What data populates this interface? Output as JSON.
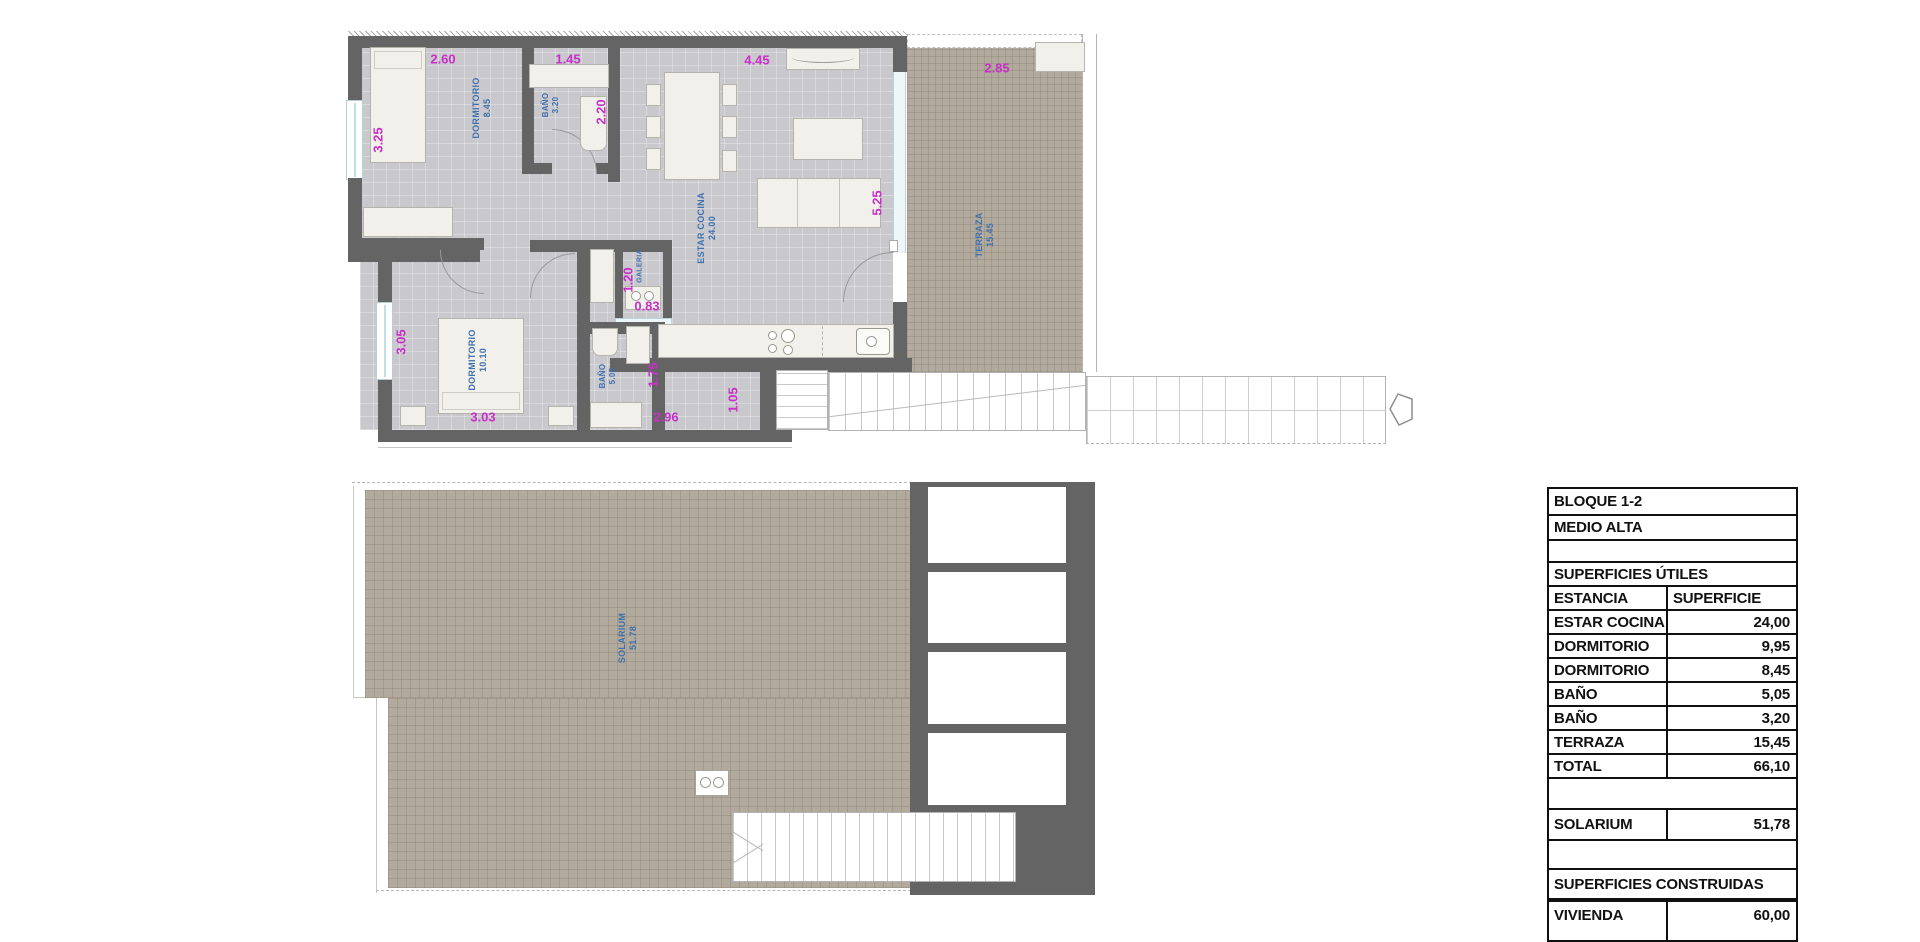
{
  "plan_upper": {
    "rooms": {
      "dormitorio1": {
        "name": "DORMITORIO",
        "area": "8.45"
      },
      "bano1": {
        "name": "BAÑO",
        "area": "3.20"
      },
      "estar_cocina": {
        "name": "ESTAR COCINA",
        "area": "24.00"
      },
      "galeria": {
        "name": "GALERIA"
      },
      "dormitorio2": {
        "name": "DORMITORIO",
        "area": "10.10"
      },
      "bano2": {
        "name": "BAÑO",
        "area": "5.05"
      },
      "terraza": {
        "name": "TERRAZA",
        "area": "15.45"
      }
    },
    "dimensions": {
      "dorm1_width": "2.60",
      "bano1_width": "1.45",
      "estar_width": "4.45",
      "terraza_width": "2.85",
      "dorm1_depth": "3.25",
      "bano1_depth": "2.20",
      "estar_depth": "5.25",
      "galeria_depth": "1.20",
      "galeria_width": "0.83",
      "dorm2_depth": "3.05",
      "dorm2_width": "3.03",
      "bano2_depth": "1.75",
      "bano2_width": "2.96",
      "entry_width": "1.05"
    }
  },
  "plan_lower": {
    "rooms": {
      "solarium": {
        "name": "SOLARIUM",
        "area": "51.78"
      }
    }
  },
  "surface_table": {
    "block": "BLOQUE 1-2",
    "level": "MEDIO ALTA",
    "useful_title": "SUPERFICIES ÚTILES",
    "columns": {
      "room": "ESTANCIA",
      "area": "SUPERFICIE"
    },
    "rows": [
      {
        "room": "ESTAR COCINA",
        "area": "24,00"
      },
      {
        "room": "DORMITORIO",
        "area": "9,95"
      },
      {
        "room": "DORMITORIO",
        "area": "8,45"
      },
      {
        "room": "BAÑO",
        "area": "5,05"
      },
      {
        "room": "BAÑO",
        "area": "3,20"
      },
      {
        "room": "TERRAZA",
        "area": "15,45"
      },
      {
        "room": "TOTAL",
        "area": "66,10"
      }
    ],
    "solarium": {
      "room": "SOLARIUM",
      "area": "51,78"
    },
    "built_title": "SUPERFICIES CONSTRUIDAS",
    "vivienda": {
      "room": "VIVIENDA",
      "area": "60,00"
    }
  },
  "colors": {
    "wall": "#646464",
    "interior_floor": "#c8c8cd",
    "outdoor_floor": "#b2aa9d",
    "dimension_text": "#c92fc9",
    "room_label_text": "#4070ae",
    "table_text": "#111111"
  }
}
